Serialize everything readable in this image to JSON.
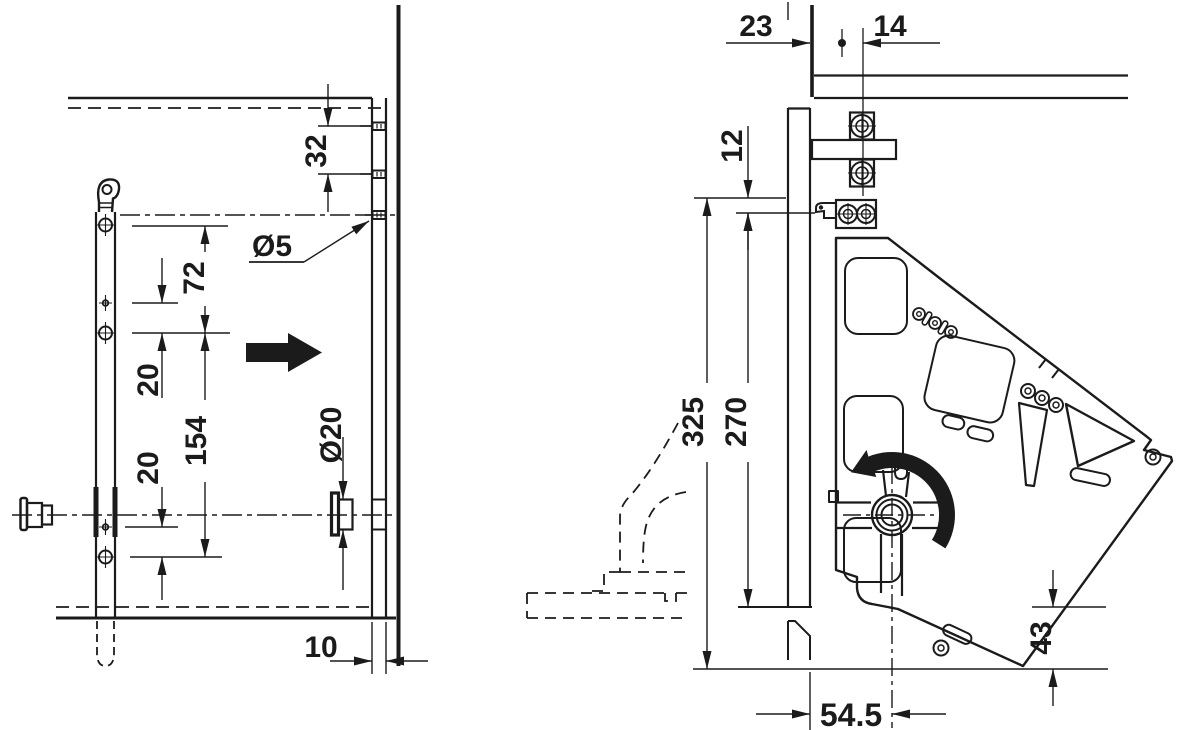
{
  "drawing": {
    "type": "furniture-fitting-installation-drawing",
    "background": "#ffffff",
    "line_color": "#1b1b1b",
    "views": {
      "left_view": {
        "description": "cabinet side panel drilling pattern",
        "dims": {
          "hole_spacing_32": "32",
          "pilot_hole_dia": "Ø5",
          "spacing_72": "72",
          "offset_20_upper": "20",
          "spacing_154": "154",
          "offset_20_lower": "20",
          "fitting_hole_dia": "Ø20",
          "edge_distance_10": "10"
        }
      },
      "right_view": {
        "description": "lift mechanism mounted at cabinet top front",
        "dims": {
          "depth_23": "23",
          "depth_14": "14",
          "offset_12": "12",
          "height_325": "325",
          "height_270": "270",
          "pivot_distance_54_5": "54.5",
          "bottom_clearance_43": "43"
        }
      }
    }
  }
}
